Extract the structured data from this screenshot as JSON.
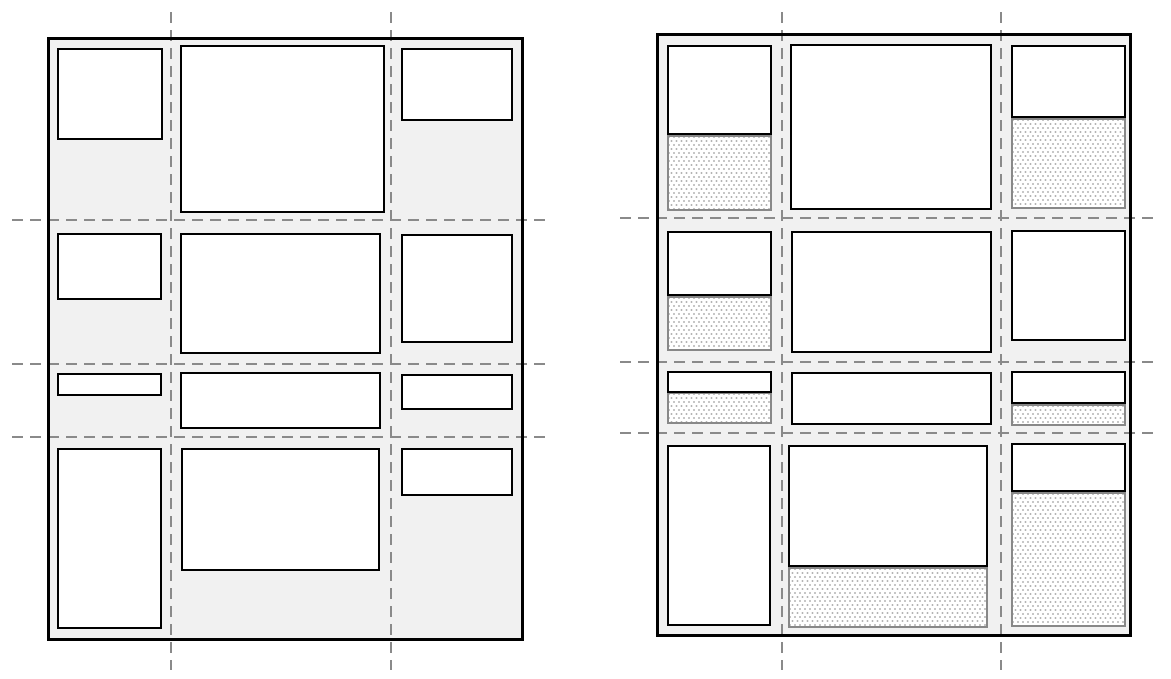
{
  "canvas": {
    "width": 1171,
    "height": 679,
    "background": "#ffffff"
  },
  "colors": {
    "page_background": "#ffffff",
    "container_fill": "#f1f1f1",
    "container_border": "#000000",
    "item_fill": "#ffffff",
    "item_border": "#000000",
    "gridline": "#8a8a8a",
    "area_border": "#888888",
    "area_dot": "#b4b4b4"
  },
  "gridline_style": {
    "thickness": 2,
    "dash": 11,
    "gap": 7
  },
  "panels": [
    {
      "name": "left-grid",
      "container": {
        "x": 47,
        "y": 37,
        "w": 477,
        "h": 604
      },
      "gridlines": {
        "vertical": [
          [
            171,
            12,
            670
          ],
          [
            391,
            12,
            670
          ]
        ],
        "horizontal": [
          [
            220,
            12,
            548
          ],
          [
            364,
            12,
            548
          ],
          [
            437,
            12,
            548
          ]
        ]
      },
      "items": [
        [
          57,
          48,
          106,
          92
        ],
        [
          180,
          45,
          205,
          168
        ],
        [
          401,
          48,
          112,
          73
        ],
        [
          57,
          233,
          105,
          67
        ],
        [
          180,
          233,
          201,
          121
        ],
        [
          401,
          234,
          112,
          109
        ],
        [
          57,
          373,
          105,
          23
        ],
        [
          180,
          372,
          201,
          57
        ],
        [
          401,
          374,
          112,
          36
        ],
        [
          57,
          448,
          105,
          181
        ],
        [
          181,
          448,
          199,
          123
        ],
        [
          401,
          448,
          112,
          48
        ]
      ],
      "areas": []
    },
    {
      "name": "right-grid",
      "container": {
        "x": 656,
        "y": 33,
        "w": 476,
        "h": 604
      },
      "gridlines": {
        "vertical": [
          [
            782,
            12,
            670
          ],
          [
            1001,
            12,
            670
          ]
        ],
        "horizontal": [
          [
            218,
            620,
            1158
          ],
          [
            362,
            620,
            1158
          ],
          [
            433,
            620,
            1158
          ]
        ]
      },
      "items": [
        [
          667,
          45,
          105,
          90
        ],
        [
          790,
          44,
          202,
          166
        ],
        [
          1011,
          45,
          115,
          73
        ],
        [
          667,
          231,
          105,
          65
        ],
        [
          791,
          231,
          201,
          122
        ],
        [
          1011,
          230,
          115,
          111
        ],
        [
          667,
          371,
          105,
          22
        ],
        [
          791,
          372,
          201,
          53
        ],
        [
          1011,
          371,
          115,
          33
        ],
        [
          667,
          445,
          104,
          181
        ],
        [
          788,
          445,
          200,
          122
        ],
        [
          1011,
          443,
          115,
          49
        ]
      ],
      "areas": [
        [
          667,
          135,
          105,
          76
        ],
        [
          1011,
          118,
          115,
          91
        ],
        [
          667,
          296,
          105,
          55
        ],
        [
          667,
          392,
          105,
          32
        ],
        [
          1011,
          404,
          115,
          22
        ],
        [
          788,
          567,
          200,
          61
        ],
        [
          1011,
          492,
          115,
          135
        ]
      ]
    }
  ]
}
